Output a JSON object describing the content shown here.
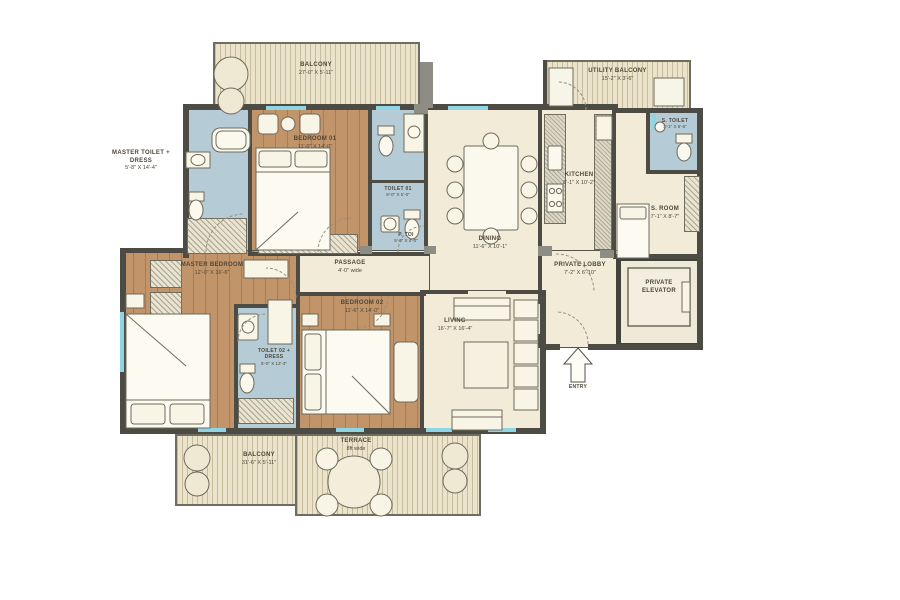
{
  "rooms": {
    "balcony_top": {
      "name": "BALCONY",
      "dim": "27'-0\" X 5'-11\""
    },
    "utility_balcony": {
      "name": "UTILITY BALCONY",
      "dim": "15'-2\" X 3'-6\""
    },
    "s_toilet": {
      "name": "S. TOILET",
      "dim": "3'-1\" X 5'-6\""
    },
    "s_room": {
      "name": "S. ROOM",
      "dim": "7'-1\" X 8'-7\""
    },
    "master_toilet": {
      "name": "MASTER TOILET + DRESS",
      "dim": "5'-8\" X 14'-4\""
    },
    "bedroom_01": {
      "name": "BEDROOM 01",
      "dim": "11'-0\" X 14'-0\""
    },
    "toilet_01": {
      "name": "TOILET 01",
      "dim": "8'-0\" X 5'-0\""
    },
    "p_toi": {
      "name": "P. TOI",
      "dim": "5'-0\" X 4'-0\""
    },
    "dining": {
      "name": "DINING",
      "dim": "11'-6\" X 10'-1\""
    },
    "kitchen": {
      "name": "KITCHEN",
      "dim": "8'-1\" X 10'-2\""
    },
    "private_lobby": {
      "name": "PRIVATE LOBBY",
      "dim": "7'-2\" X 6'-10\""
    },
    "private_elevator": {
      "name": "PRIVATE ELEVATOR"
    },
    "passage": {
      "name": "PASSAGE",
      "dim": "4'-0\" wide"
    },
    "master_bedroom": {
      "name": "MASTER BEDROOM",
      "dim": "12'-0\" X 16'-6\""
    },
    "toilet_02": {
      "name": "TOILET 02 + DRESS",
      "dim": "5'-0\" X 12'-3\""
    },
    "bedroom_02": {
      "name": "BEDROOM 02",
      "dim": "11'-6\" X 14'-0\""
    },
    "living": {
      "name": "LIVING",
      "dim": "16'-7\" X 16'-4\""
    },
    "terrace": {
      "name": "TERRACE",
      "dim": "8ft wide"
    },
    "balcony_bottom": {
      "name": "BALCONY",
      "dim": "31'-6\" X 5'-11\""
    },
    "entry": {
      "label": "ENTRY"
    }
  },
  "colors": {
    "wall": "#4c4b44",
    "wood_floor": "#c2946a",
    "toilet_blue": "#b5ccd6",
    "room_cream": "#f1ebd8",
    "balcony_stripe": "#ece4ca",
    "window_glass": "#8fd5e4",
    "background": "#ffffff"
  }
}
